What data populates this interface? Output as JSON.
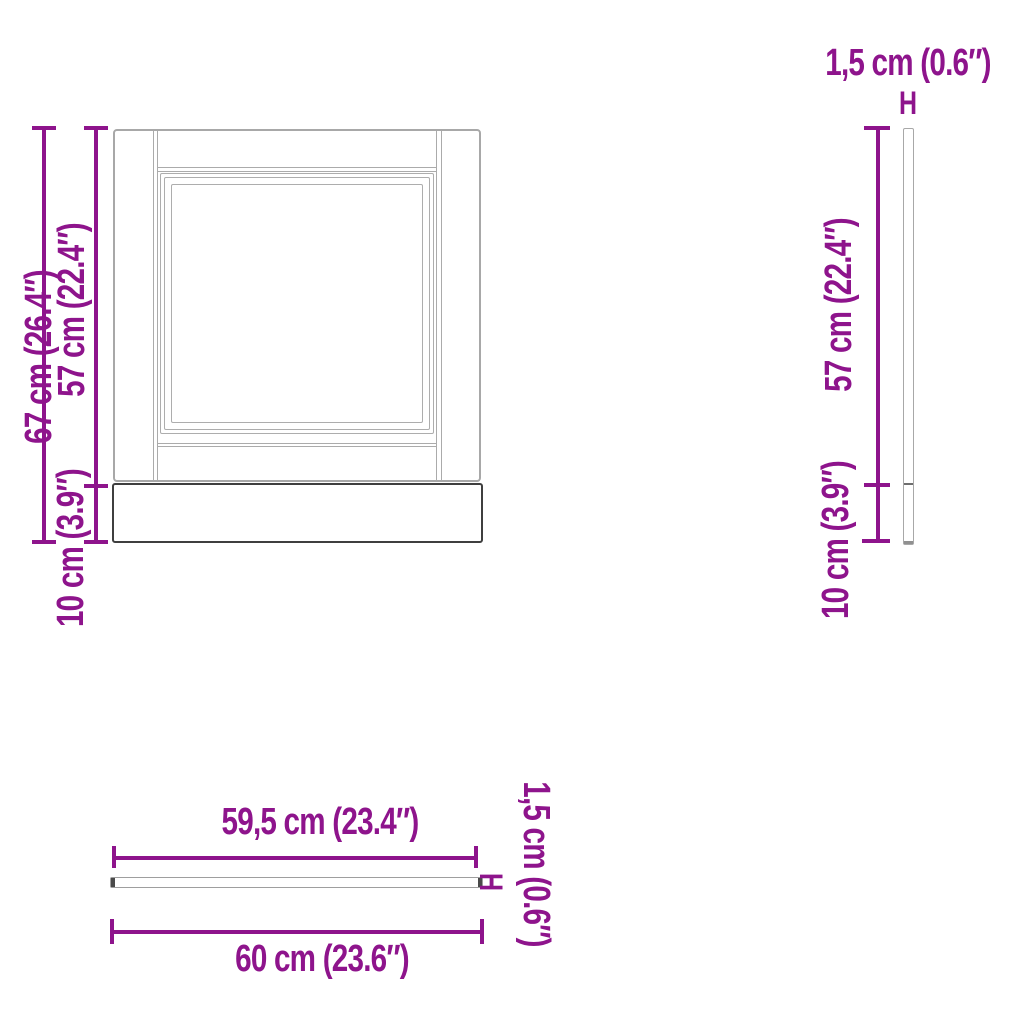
{
  "front_view": {
    "total_height": "67 cm (26.4″)",
    "panel_height": "57 cm (22.4″)",
    "plinth_height": "10 cm (3.9″)"
  },
  "side_view": {
    "thickness": "1,5 cm (0.6″)",
    "thickness_marker": "H",
    "panel_height": "57 cm (22.4″)",
    "plinth_height": "10 cm (3.9″)"
  },
  "top_view": {
    "panel_width": "59,5 cm (23.4″)",
    "total_width": "60 cm (23.6″)",
    "thickness": "1,5 cm (0.6″)",
    "thickness_marker": "H"
  },
  "colors": {
    "dimension_accent": "#8e148c",
    "drawing_light_gray": "#a8a8a8",
    "drawing_dark_gray": "#3f3f3f"
  }
}
